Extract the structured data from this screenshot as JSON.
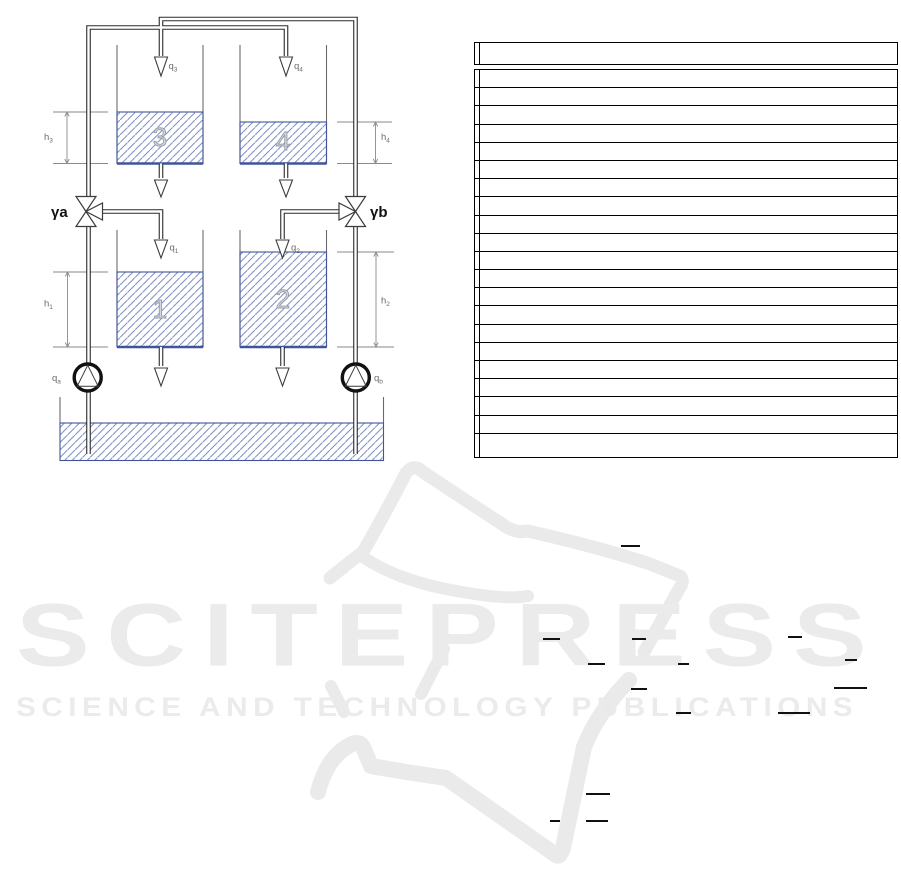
{
  "figure": {
    "valves": {
      "a": "γa",
      "b": "γb"
    },
    "tank_numbers": {
      "t1": "1",
      "t2": "2",
      "t3": "3",
      "t4": "4"
    },
    "flows": {
      "q1": {
        "main": "q",
        "sub": "1"
      },
      "q2": {
        "main": "q",
        "sub": "2"
      },
      "q3": {
        "main": "q",
        "sub": "3"
      },
      "q4": {
        "main": "q",
        "sub": "4"
      },
      "qa": {
        "main": "q",
        "sub": "a"
      },
      "qb": {
        "main": "q",
        "sub": "b"
      }
    },
    "levels": {
      "h1": {
        "main": "h",
        "sub": "1"
      },
      "h2": {
        "main": "h",
        "sub": "2"
      },
      "h3": {
        "main": "h",
        "sub": "3"
      },
      "h4": {
        "main": "h",
        "sub": "4"
      }
    },
    "colors": {
      "hatch": "#7e8fc2",
      "water_border": "#41549b",
      "pipe_line": "#2a2a2a",
      "tank_wall": "#6a6a6a",
      "dimension": "#8a8a8a",
      "label": "#6b6b6b",
      "tank_number_fill": "#d4d8df",
      "tank_number_stroke": "#959ca9"
    }
  },
  "table": {
    "header": "",
    "rows": [
      "",
      "",
      "",
      "",
      "",
      "",
      "",
      "",
      "",
      "",
      "",
      "",
      "",
      "",
      "",
      "",
      "",
      "",
      "",
      "",
      ""
    ]
  },
  "watermark": {
    "title": "SCITEPRESS",
    "subtitle": "SCIENCE AND TECHNOLOGY PUBLICATIONS",
    "color": "#ebebeb"
  },
  "equation_bars": [
    {
      "x": 621,
      "y": 545,
      "w": 19
    },
    {
      "x": 543,
      "y": 638,
      "w": 17
    },
    {
      "x": 632,
      "y": 638,
      "w": 14
    },
    {
      "x": 788,
      "y": 636,
      "w": 14
    },
    {
      "x": 588,
      "y": 663,
      "w": 17
    },
    {
      "x": 678,
      "y": 663,
      "w": 11
    },
    {
      "x": 845,
      "y": 659,
      "w": 12
    },
    {
      "x": 631,
      "y": 688,
      "w": 16
    },
    {
      "x": 834,
      "y": 687,
      "w": 33
    },
    {
      "x": 676,
      "y": 712,
      "w": 15
    },
    {
      "x": 778,
      "y": 712,
      "w": 32
    },
    {
      "x": 586,
      "y": 793,
      "w": 24
    },
    {
      "x": 550,
      "y": 820,
      "w": 10
    },
    {
      "x": 586,
      "y": 820,
      "w": 22
    }
  ]
}
